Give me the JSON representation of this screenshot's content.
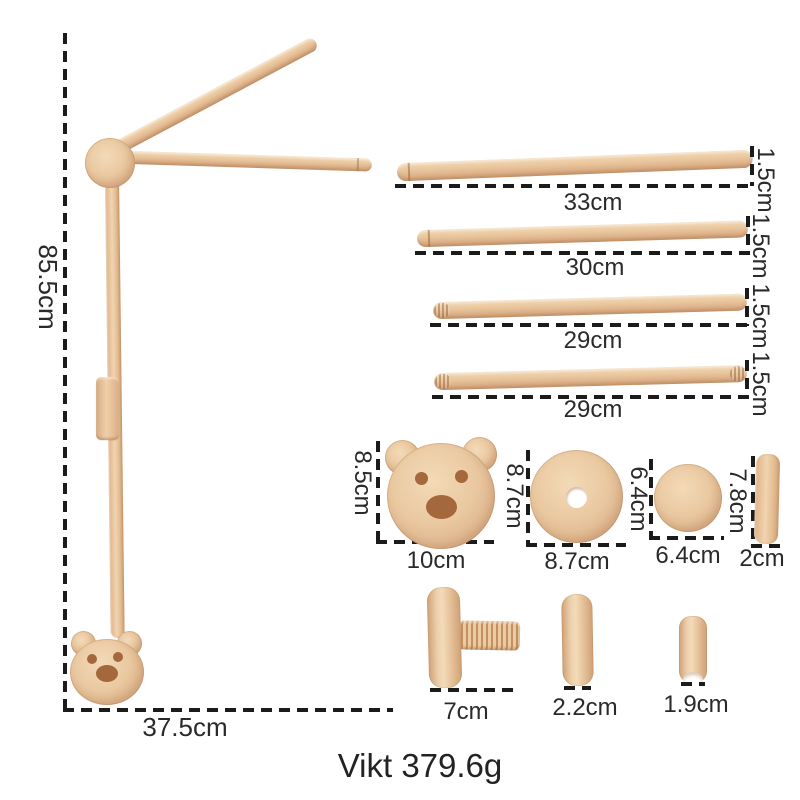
{
  "assembly": {
    "height_label": "85.5cm",
    "width_label": "37.5cm"
  },
  "rods": [
    {
      "length_label": "33cm",
      "diameter_label": "1.5cm"
    },
    {
      "length_label": "30cm",
      "diameter_label": "1.5cm"
    },
    {
      "length_label": "29cm",
      "diameter_label": "1.5cm"
    },
    {
      "length_label": "29cm",
      "diameter_label": "1.5cm"
    }
  ],
  "parts": {
    "bear_plate": {
      "height_label": "8.5cm",
      "width_label": "10cm"
    },
    "disc_with_hole": {
      "height_label": "8.7cm",
      "width_label": "8.7cm"
    },
    "small_disc": {
      "height_label": "6.4cm",
      "width_label": "6.4cm"
    },
    "cylinder": {
      "height_label": "7.8cm",
      "width_label": "2cm"
    },
    "screw_knob": {
      "width_label": "7cm"
    },
    "thick_disc": {
      "width_label": "2.2cm"
    },
    "ring": {
      "width_label": "1.9cm"
    }
  },
  "weight": {
    "label": "Vikt 379.6g"
  },
  "colors": {
    "background": "#ffffff",
    "wood_light": "#f3dab8",
    "wood_mid": "#e6c098",
    "wood_dark": "#cfa077",
    "bear_feature": "#a4683c",
    "dimension_line": "#1b1b1b",
    "text": "#2a2a2a"
  }
}
